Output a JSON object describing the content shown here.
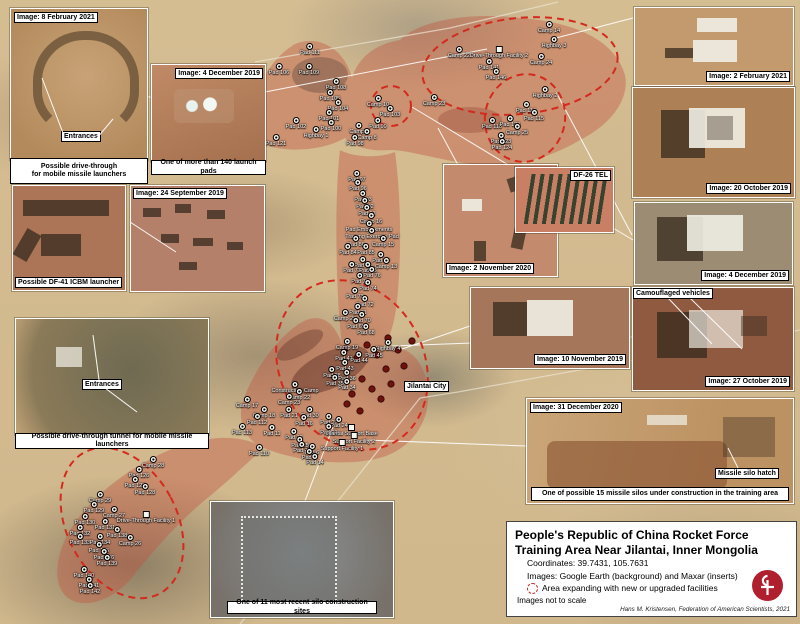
{
  "title_box": {
    "title": "People's Republic of China Rocket Force Training Area Near Jilantai, Inner Mongolia",
    "coordinates": "Coordinates: 39.7431, 105.7631",
    "images_credit": "Images: Google Earth (background) and Maxar (inserts)",
    "legend_label": "Area expanding with new or upgraded facilities",
    "scale_note": "Images not to scale",
    "author_credit": "Hans M. Kristensen, Federation of American Scientists, 2021",
    "logo_color": "#b01f2e"
  },
  "insets": {
    "feb8": {
      "label": "Image: 8 February 2021",
      "inner_label": "Entrances",
      "caption_line1": "Possible drive-through",
      "caption_line2": "for mobile missile launchers"
    },
    "dec4a": {
      "label": "Image: 4 December 2019",
      "caption": "One of more than 140 launch pads"
    },
    "df41": {
      "caption": "Possible DF-41 ICBM launcher"
    },
    "sep24": {
      "label": "Image: 24 September 2019"
    },
    "tunnel": {
      "inner_label": "Entrances",
      "caption": "Possible drive-through tunnel for mobile missile launchers"
    },
    "silocon": {
      "caption": "One of 11 most recent silo construction sites"
    },
    "nov2": {
      "label": "Image: 2 November 2020"
    },
    "df26": {
      "label": "DF-26 TEL"
    },
    "nov10": {
      "label": "Image: 10 November 2019"
    },
    "feb2": {
      "label": "Image: 2 February 2021"
    },
    "oct20": {
      "label": "Image: 20 October 2019"
    },
    "dec4b": {
      "label": "Image: 4 December 2019"
    },
    "oct27": {
      "label": "Image: 27 October 2019",
      "inner_label": "Camouflaged vehicles"
    },
    "dec31": {
      "label": "Image: 31 December 2020",
      "inner_label": "Missile silo hatch",
      "caption": "One of possible 15 missile silos under construction in the training area"
    }
  },
  "labels": {
    "jilantai_city": "Jilantai City"
  },
  "annotation_colors": {
    "expansion_dash": "#d42a1e",
    "area_fill": "rgba(193,86,66,0.42)"
  },
  "map_labels": [
    [
      "Pad 111",
      310,
      46,
      "p"
    ],
    [
      "Pad 106",
      279,
      66,
      "p"
    ],
    [
      "Pad 109",
      309,
      66,
      "p"
    ],
    [
      "Pad 108",
      336,
      81,
      "p"
    ],
    [
      "Pad 105",
      330,
      92,
      "p"
    ],
    [
      "Pad 104",
      338,
      102,
      "p"
    ],
    [
      "Pad 101",
      329,
      112,
      "p"
    ],
    [
      "Camp 10",
      378,
      98,
      "c"
    ],
    [
      "Pad 103",
      390,
      108,
      "p"
    ],
    [
      "Pad 102",
      296,
      120,
      "p"
    ],
    [
      "Pad 100",
      331,
      122,
      "p"
    ],
    [
      "Highbay 1",
      316,
      129,
      "c"
    ],
    [
      "Pad 99",
      378,
      120,
      "p"
    ],
    [
      "Camp 9",
      359,
      125,
      "c"
    ],
    [
      "Camp 8",
      367,
      131,
      "c"
    ],
    [
      "Pad 98",
      355,
      137,
      "p"
    ],
    [
      "Pad 121",
      276,
      137,
      "p"
    ],
    [
      "Camp 14",
      549,
      24,
      "c"
    ],
    [
      "Highbay 3",
      554,
      39,
      "c"
    ],
    [
      "Camp 22",
      459,
      49,
      "c"
    ],
    [
      "Drive-Through Facility 2",
      499,
      49,
      "f"
    ],
    [
      "Pad 141",
      489,
      61,
      "p"
    ],
    [
      "Camp 24",
      541,
      56,
      "c"
    ],
    [
      "Pad 146",
      496,
      71,
      "p"
    ],
    [
      "Camp 23",
      434,
      97,
      "c"
    ],
    [
      "Highbay 2",
      545,
      89,
      "c"
    ],
    [
      "Pad 114",
      526,
      104,
      "p"
    ],
    [
      "Pad 115",
      534,
      112,
      "p"
    ],
    [
      "Pad 118",
      492,
      120,
      "p"
    ],
    [
      "Pad 120",
      510,
      118,
      "p"
    ],
    [
      "Camp 25",
      517,
      126,
      "c"
    ],
    [
      "Pad 123",
      501,
      135,
      "p"
    ],
    [
      "Pad 124",
      502,
      141,
      "p"
    ],
    [
      "Pad 97",
      357,
      173,
      "p"
    ],
    [
      "Pad 96",
      358,
      182,
      "p"
    ],
    [
      "Pad 93",
      363,
      193,
      "p"
    ],
    [
      "Pad 92",
      365,
      200,
      "p"
    ],
    [
      "Pad 91",
      367,
      207,
      "p"
    ],
    [
      "Camp 16",
      371,
      215,
      "c"
    ],
    [
      "Pad Embankments",
      369,
      223,
      "p"
    ],
    [
      "Training Exercise Pad",
      372,
      230,
      "p"
    ],
    [
      "Pad 86",
      356,
      238,
      "p"
    ],
    [
      "Camp 15",
      383,
      238,
      "c"
    ],
    [
      "Pad 84",
      348,
      246,
      "p"
    ],
    [
      "Pad 85",
      366,
      246,
      "p"
    ],
    [
      "Pad 80",
      381,
      254,
      "p"
    ],
    [
      "Pad 79",
      363,
      259,
      "p"
    ],
    [
      "Camp 13",
      386,
      260,
      "c"
    ],
    [
      "Pad 77",
      352,
      264,
      "p"
    ],
    [
      "Pad 78",
      368,
      264,
      "p"
    ],
    [
      "Pad 76",
      372,
      269,
      "p"
    ],
    [
      "Pad 75",
      360,
      275,
      "p"
    ],
    [
      "Pad 74",
      368,
      282,
      "p"
    ],
    [
      "Pad 73",
      355,
      290,
      "p"
    ],
    [
      "Pad 72",
      365,
      298,
      "p"
    ],
    [
      "Pad 71",
      358,
      306,
      "p"
    ],
    [
      "Camp 20",
      345,
      312,
      "c"
    ],
    [
      "Pad 70",
      362,
      314,
      "p"
    ],
    [
      "Pad 69",
      356,
      320,
      "p"
    ],
    [
      "Pad 68",
      366,
      326,
      "p"
    ],
    [
      "Highbay 4",
      388,
      342,
      "c"
    ],
    [
      "Camp 19",
      347,
      341,
      "c"
    ],
    [
      "Pad 45",
      374,
      349,
      "p"
    ],
    [
      "Pad 41",
      344,
      352,
      "p"
    ],
    [
      "Pad 44",
      359,
      354,
      "p"
    ],
    [
      "Pad 43",
      345,
      362,
      "p"
    ],
    [
      "Pad 38",
      332,
      369,
      "p"
    ],
    [
      "Pad 36",
      347,
      372,
      "p"
    ],
    [
      "Pad 35",
      335,
      377,
      "p"
    ],
    [
      "Pad 34",
      347,
      381,
      "p"
    ],
    [
      "Construction Camp",
      295,
      384,
      "c"
    ],
    [
      "Camp 22",
      299,
      391,
      "c"
    ],
    [
      "Camp 23",
      289,
      396,
      "c"
    ],
    [
      "Camp 17",
      247,
      399,
      "c"
    ],
    [
      "Camp 18",
      264,
      409,
      "c"
    ],
    [
      "Pad 21",
      289,
      409,
      "p"
    ],
    [
      "Pad 30",
      310,
      409,
      "p"
    ],
    [
      "Pad 112",
      257,
      416,
      "p"
    ],
    [
      "Pad 16",
      304,
      417,
      "p"
    ],
    [
      "Pad 22",
      329,
      416,
      "p"
    ],
    [
      "Pad 113",
      242,
      426,
      "p"
    ],
    [
      "Pad 11",
      272,
      427,
      "p"
    ],
    [
      "Pad 12",
      294,
      431,
      "p"
    ],
    [
      "Pad 24",
      339,
      419,
      "p"
    ],
    [
      "Pad 23",
      329,
      426,
      "p"
    ],
    [
      "Jilantai Support Base",
      352,
      427,
      "f"
    ],
    [
      "Support Facility 2",
      354,
      435,
      "f"
    ],
    [
      "Support Facility 1",
      342,
      442,
      "f"
    ],
    [
      "Pad 110",
      259,
      447,
      "p"
    ],
    [
      "Pad 15",
      300,
      439,
      "p"
    ],
    [
      "Pad 13",
      302,
      444,
      "p"
    ],
    [
      "Pad 6",
      312,
      446,
      "p"
    ],
    [
      "Pad 5",
      309,
      451,
      "p"
    ],
    [
      "Pad 14",
      315,
      456,
      "p"
    ],
    [
      "Camp 28",
      153,
      459,
      "c"
    ],
    [
      "Pad 126",
      139,
      469,
      "p"
    ],
    [
      "Pad 127",
      135,
      479,
      "p"
    ],
    [
      "Pad 128",
      145,
      486,
      "p"
    ],
    [
      "Camp 29",
      100,
      494,
      "c"
    ],
    [
      "Pad 129",
      94,
      504,
      "p"
    ],
    [
      "Camp 27",
      114,
      509,
      "c"
    ],
    [
      "Drive-Through Facility 1",
      146,
      514,
      "f"
    ],
    [
      "Pad 130",
      85,
      516,
      "p"
    ],
    [
      "Pad 131",
      105,
      521,
      "p"
    ],
    [
      "Pad 132",
      80,
      527,
      "p"
    ],
    [
      "Pad 133",
      80,
      536,
      "p"
    ],
    [
      "Pad 134",
      100,
      536,
      "p"
    ],
    [
      "Pad 138",
      117,
      529,
      "p"
    ],
    [
      "Camp 26",
      130,
      537,
      "c"
    ],
    [
      "Pad 135",
      99,
      544,
      "p"
    ],
    [
      "Pad 136",
      104,
      551,
      "p"
    ],
    [
      "Pad 139",
      107,
      557,
      "p"
    ],
    [
      "Pad 140",
      84,
      569,
      "p"
    ],
    [
      "Pad 141",
      89,
      579,
      "p"
    ],
    [
      "Pad 142",
      90,
      585,
      "p"
    ]
  ],
  "silo_dots": [
    [
      345,
      349
    ],
    [
      357,
      358
    ],
    [
      367,
      345
    ],
    [
      377,
      355
    ],
    [
      386,
      369
    ],
    [
      362,
      379
    ],
    [
      372,
      389
    ],
    [
      352,
      394
    ],
    [
      381,
      399
    ],
    [
      391,
      384
    ],
    [
      347,
      404
    ],
    [
      360,
      411
    ],
    [
      398,
      350
    ],
    [
      404,
      366
    ],
    [
      412,
      341
    ],
    [
      388,
      338
    ]
  ],
  "expansion_ellipses": [
    {
      "cx": 520,
      "cy": 66,
      "rx": 98,
      "ry": 48,
      "rot": -6
    },
    {
      "cx": 525,
      "cy": 118,
      "rx": 40,
      "ry": 44,
      "rot": 12
    },
    {
      "cx": 391,
      "cy": 106,
      "rx": 20,
      "ry": 20,
      "rot": 0
    },
    {
      "cx": 352,
      "cy": 365,
      "rx": 72,
      "ry": 88,
      "rot": -28
    },
    {
      "cx": 122,
      "cy": 523,
      "rx": 55,
      "ry": 80,
      "rot": -28
    }
  ],
  "leader_lines": [
    [
      146,
      96,
      258,
      127
    ],
    [
      265,
      92,
      487,
      49
    ],
    [
      556,
      38,
      633,
      18
    ],
    [
      556,
      92,
      632,
      235
    ],
    [
      392,
      346,
      632,
      337
    ],
    [
      366,
      440,
      526,
      446
    ],
    [
      333,
      427,
      305,
      501
    ],
    [
      438,
      128,
      458,
      165
    ],
    [
      470,
      326,
      402,
      349
    ],
    [
      412,
      107,
      633,
      240
    ]
  ],
  "inset_leader_lines": [
    [
      63,
      133,
      42,
      78
    ],
    [
      97,
      138,
      113,
      119
    ],
    [
      99,
      380,
      93,
      335
    ],
    [
      105,
      388,
      137,
      412
    ],
    [
      130,
      222,
      176,
      252
    ],
    [
      668,
      298,
      712,
      344
    ],
    [
      690,
      298,
      742,
      349
    ],
    [
      738,
      468,
      728,
      448
    ]
  ],
  "roads": [
    [
      240,
      624,
      420,
      398
    ],
    [
      420,
      398,
      458,
      392
    ],
    [
      458,
      392,
      800,
      330
    ],
    [
      255,
      62,
      450,
      28
    ],
    [
      450,
      28,
      558,
      2
    ]
  ]
}
